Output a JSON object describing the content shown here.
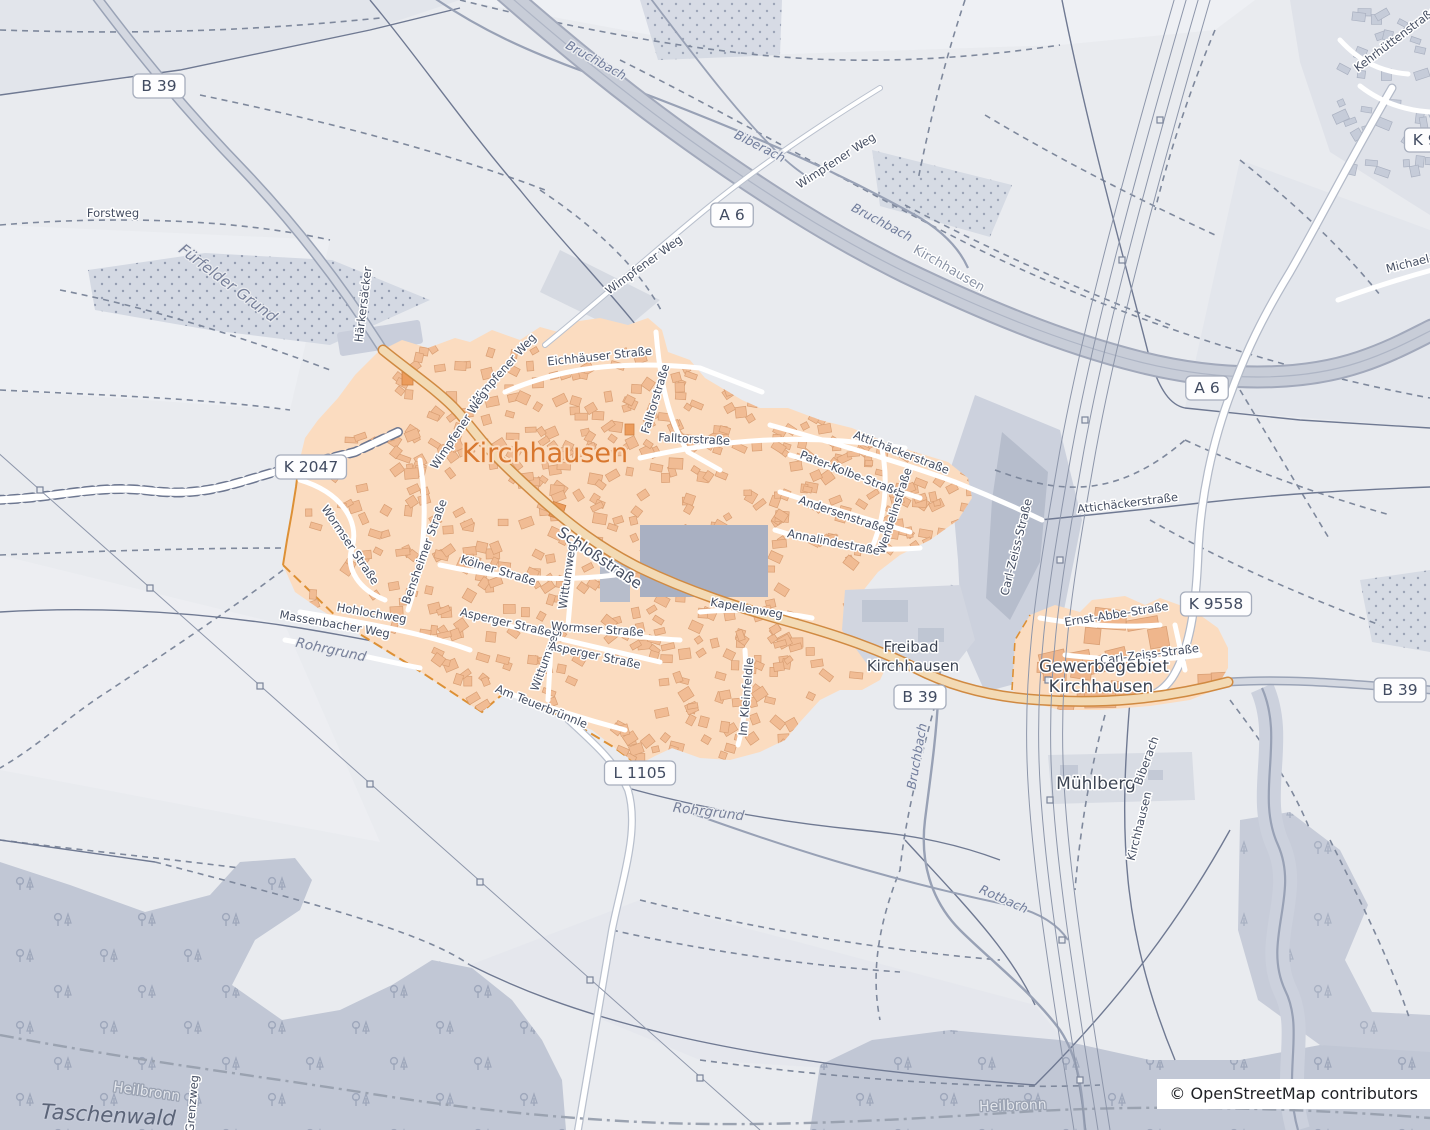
{
  "map": {
    "attribution": "© OpenStreetMap contributors",
    "colors": {
      "background": "#e9ebef",
      "town_fill": "#fbdcc0",
      "building_fill": "#f1bc94",
      "town_label": "#d8772e",
      "road_orange_casing": "#d08a42",
      "road_orange_fill": "#f3dab4",
      "motorway_fill": "#c8cdd8",
      "forest_fill": "#bfc5d4",
      "water_line": "#98a1b5",
      "street_label": "#454e62",
      "badge_text": "#414b61"
    },
    "road_badges": [
      {
        "text": "B 39",
        "x": 159,
        "y": 86
      },
      {
        "text": "A 6",
        "x": 732,
        "y": 215
      },
      {
        "text": "A 6",
        "x": 1207,
        "y": 388
      },
      {
        "text": "K 2047",
        "x": 311,
        "y": 467
      },
      {
        "text": "K 9558",
        "x": 1440,
        "y": 140
      },
      {
        "text": "K 9558",
        "x": 1216,
        "y": 604
      },
      {
        "text": "B 39",
        "x": 920,
        "y": 697
      },
      {
        "text": "B 39",
        "x": 1400,
        "y": 690
      },
      {
        "text": "L 1105",
        "x": 640,
        "y": 773
      }
    ],
    "labels": [
      {
        "text": "Forstweg",
        "x": 113,
        "y": 217,
        "r": 0,
        "k": "street"
      },
      {
        "text": "Fürfelder Grund",
        "x": 225,
        "y": 287,
        "r": 37,
        "k": "landscape",
        "s": 15
      },
      {
        "text": "Härkersäcker",
        "x": 367,
        "y": 305,
        "r": -83,
        "k": "street"
      },
      {
        "text": "Bruchbach",
        "x": 594,
        "y": 64,
        "r": 29,
        "k": "water"
      },
      {
        "text": "Biberach",
        "x": 758,
        "y": 150,
        "r": 27,
        "k": "water"
      },
      {
        "text": "Bruchbach",
        "x": 880,
        "y": 226,
        "r": 28,
        "k": "water"
      },
      {
        "text": "Kirchhausen",
        "x": 947,
        "y": 272,
        "r": 30,
        "k": "boundary"
      },
      {
        "text": "Wimpfener Weg",
        "x": 838,
        "y": 164,
        "r": -33,
        "k": "street"
      },
      {
        "text": "Wimpfener Weg",
        "x": 646,
        "y": 268,
        "r": -36,
        "k": "street"
      },
      {
        "text": "Kehrhüttenstraße",
        "x": 1398,
        "y": 42,
        "r": -37,
        "k": "street"
      },
      {
        "text": "Michael-V",
        "x": 1414,
        "y": 266,
        "r": -14,
        "k": "street"
      },
      {
        "text": "Eichhäuser Straße",
        "x": 600,
        "y": 360,
        "r": -6,
        "k": "street"
      },
      {
        "text": "Falltorstraße",
        "x": 659,
        "y": 400,
        "r": -73,
        "k": "street"
      },
      {
        "text": "Falltorstraße",
        "x": 694,
        "y": 443,
        "r": 3,
        "k": "street"
      },
      {
        "text": "Wimpfener Weg",
        "x": 506,
        "y": 372,
        "r": -48,
        "k": "street"
      },
      {
        "text": "Wimpfener Weg",
        "x": 462,
        "y": 432,
        "r": -56,
        "k": "street"
      },
      {
        "text": "Kirchhausen",
        "x": 545,
        "y": 462,
        "r": 0,
        "k": "town"
      },
      {
        "text": "Attichäckerstraße",
        "x": 900,
        "y": 456,
        "r": 21,
        "k": "street"
      },
      {
        "text": "Pater-Kolbe-Straße",
        "x": 849,
        "y": 477,
        "r": 21,
        "k": "street"
      },
      {
        "text": "Andersenstraße",
        "x": 841,
        "y": 518,
        "r": 19,
        "k": "street"
      },
      {
        "text": "Wendelinstraße",
        "x": 898,
        "y": 512,
        "r": -72,
        "k": "street"
      },
      {
        "text": "Annalindestraße",
        "x": 833,
        "y": 546,
        "r": 11,
        "k": "street"
      },
      {
        "text": "Attichäckerstraße",
        "x": 1128,
        "y": 507,
        "r": -7,
        "k": "street"
      },
      {
        "text": "Carl-Zeiss-Straße",
        "x": 1020,
        "y": 548,
        "r": -76,
        "k": "street"
      },
      {
        "text": "Schloßstraße",
        "x": 597,
        "y": 562,
        "r": 34,
        "k": "streetlg"
      },
      {
        "text": "Wormser Straße",
        "x": 347,
        "y": 547,
        "r": 56,
        "k": "street"
      },
      {
        "text": "Bensheimer Straße",
        "x": 428,
        "y": 553,
        "r": -70,
        "k": "street"
      },
      {
        "text": "Kölner Straße",
        "x": 497,
        "y": 574,
        "r": 17,
        "k": "street"
      },
      {
        "text": "Hohlochweg",
        "x": 371,
        "y": 617,
        "r": 10,
        "k": "street"
      },
      {
        "text": "Massenbacher Weg",
        "x": 334,
        "y": 628,
        "r": 10,
        "k": "street"
      },
      {
        "text": "Rohrgrund",
        "x": 330,
        "y": 654,
        "r": 12,
        "k": "landscape"
      },
      {
        "text": "Wittumweg",
        "x": 571,
        "y": 577,
        "r": -82,
        "k": "street"
      },
      {
        "text": "Wittumweg",
        "x": 549,
        "y": 661,
        "r": -70,
        "k": "street"
      },
      {
        "text": "Wormser Straße",
        "x": 597,
        "y": 633,
        "r": 4,
        "k": "street"
      },
      {
        "text": "Asperger Straße",
        "x": 505,
        "y": 626,
        "r": 13,
        "k": "street"
      },
      {
        "text": "Asperger Straße",
        "x": 594,
        "y": 659,
        "r": 12,
        "k": "street"
      },
      {
        "text": "Am Teuerbrünnle",
        "x": 540,
        "y": 710,
        "r": 22,
        "k": "street"
      },
      {
        "text": "Kapellenweg",
        "x": 746,
        "y": 612,
        "r": 10,
        "k": "street"
      },
      {
        "text": "Im Kleinfeldle",
        "x": 750,
        "y": 697,
        "r": -85,
        "k": "street"
      },
      {
        "text": "Freibad",
        "x": 911,
        "y": 652,
        "r": 0,
        "k": "place"
      },
      {
        "text": "Kirchhausen",
        "x": 913,
        "y": 671,
        "r": 0,
        "k": "place"
      },
      {
        "text": "Ernst-Abbe-Straße",
        "x": 1117,
        "y": 618,
        "r": -9,
        "k": "street"
      },
      {
        "text": "Carl-Zeiss-Straße",
        "x": 1150,
        "y": 658,
        "r": -7,
        "k": "street"
      },
      {
        "text": "Gewerbegebiet",
        "x": 1104,
        "y": 672,
        "r": 0,
        "k": "placelg"
      },
      {
        "text": "Kirchhausen",
        "x": 1101,
        "y": 692,
        "r": 0,
        "k": "placelg"
      },
      {
        "text": "Mühlberg",
        "x": 1096,
        "y": 789,
        "r": 0,
        "k": "placelg"
      },
      {
        "text": "Bruchbach",
        "x": 921,
        "y": 757,
        "r": -80,
        "k": "water"
      },
      {
        "text": "Biberach",
        "x": 1150,
        "y": 762,
        "r": -70,
        "k": "street"
      },
      {
        "text": "Kirchhausen",
        "x": 1143,
        "y": 827,
        "r": -76,
        "k": "street"
      },
      {
        "text": "Rohrgrund",
        "x": 708,
        "y": 816,
        "r": 7,
        "k": "landscape"
      },
      {
        "text": "Rotbach",
        "x": 1002,
        "y": 903,
        "r": 24,
        "k": "water"
      },
      {
        "text": "Heilbronn",
        "x": 146,
        "y": 1096,
        "r": 8,
        "k": "boundarylight"
      },
      {
        "text": "Heilbronn",
        "x": 1013,
        "y": 1110,
        "r": -2,
        "k": "boundarylight"
      },
      {
        "text": "Taschenwald",
        "x": 108,
        "y": 1122,
        "r": 3,
        "k": "landscapelg"
      },
      {
        "text": "Grenzweg",
        "x": 196,
        "y": 1104,
        "r": -85,
        "k": "street"
      }
    ]
  }
}
